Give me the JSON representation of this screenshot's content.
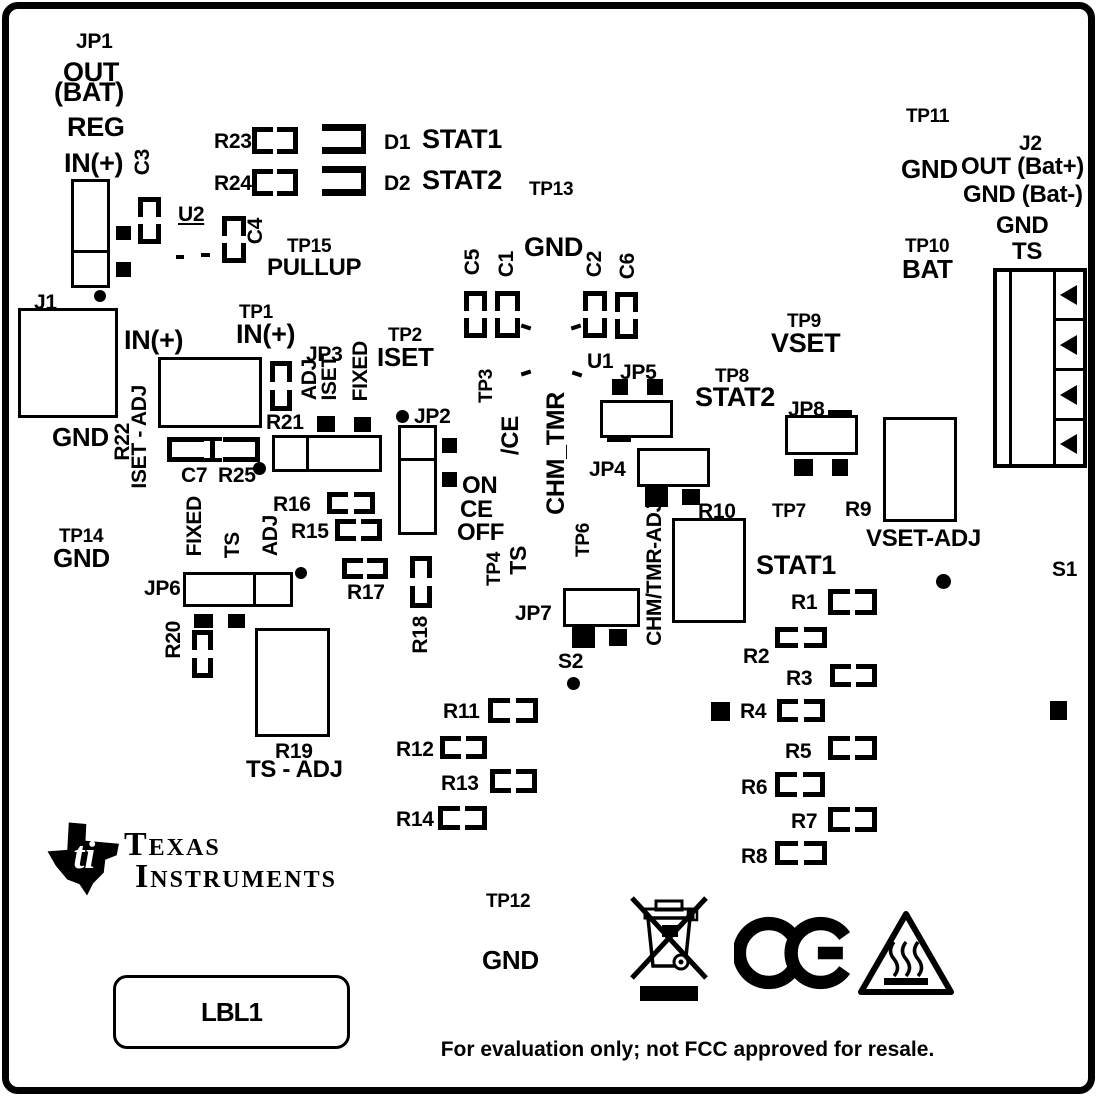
{
  "board": {
    "type": "pcb-silkscreen-diagram",
    "silkscreen_color": "#000000",
    "board_color": "#ffffff"
  },
  "labels": {
    "jp1": "JP1",
    "jp1_out": "OUT",
    "jp1_bat": "(BAT)",
    "jp1_reg": "REG",
    "jp1_in": "IN(+)",
    "c3": "C3",
    "u2": "U2",
    "c4": "C4",
    "tp15": "TP15",
    "pullup": "PULLUP",
    "r23": "R23",
    "r24": "R24",
    "d1": "D1",
    "d1_name": "STAT1",
    "d2": "D2",
    "d2_name": "STAT2",
    "tp13": "TP13",
    "gnd_top": "GND",
    "c5": "C5",
    "c1": "C1",
    "c2": "C2",
    "c6": "C6",
    "u1": "U1",
    "tp11": "TP11",
    "tp11_gnd": "GND",
    "j2": "J2",
    "j2_out": "OUT (Bat+)",
    "j2_gnd": "GND (Bat-)",
    "j2_gnd2": "GND",
    "j2_ts": "TS",
    "tp10": "TP10",
    "tp10_bat": "BAT",
    "j1": "J1",
    "j1_in": "IN(+)",
    "j1_gnd": "GND",
    "tp1": "TP1",
    "tp1_in": "IN(+)",
    "r22": "R22",
    "iset_adj": "ISET - ADJ",
    "c7": "C7",
    "r25": "R25",
    "r21": "R21",
    "jp3": "JP3",
    "jp3_adj": "ADJ",
    "jp3_iset": "ISET",
    "jp3_fixed": "FIXED",
    "tp2": "TP2",
    "tp2_iset": "ISET",
    "jp2": "JP2",
    "jp2_on": "ON",
    "jp2_ce": "CE",
    "jp2_off": "OFF",
    "tp3": "TP3",
    "ce_bar": "/CE",
    "chm_tmr": "CHM_TMR",
    "jp5": "JP5",
    "jp4": "JP4",
    "r10": "R10",
    "chm_tmr_adj": "CHM/TMR-ADJ",
    "tp6": "TP6",
    "jp7": "JP7",
    "s2": "S2",
    "tp4": "TP4",
    "tp4_ts": "TS",
    "tp9": "TP9",
    "tp9_vset": "VSET",
    "tp8": "TP8",
    "tp8_stat2": "STAT2",
    "jp8": "JP8",
    "tp7": "TP7",
    "r9": "R9",
    "vset_adj": "VSET-ADJ",
    "stat1": "STAT1",
    "r1": "R1",
    "r2": "R2",
    "r3": "R3",
    "r4": "R4",
    "r5": "R5",
    "r6": "R6",
    "r7": "R7",
    "r8": "R8",
    "s1": "S1",
    "tp14": "TP14",
    "tp14_gnd": "GND",
    "jp6": "JP6",
    "jp6_fixed": "FIXED",
    "jp6_ts": "TS",
    "jp6_adj": "ADJ",
    "r20": "R20",
    "r19": "R19",
    "ts_adj": "TS - ADJ",
    "r15": "R15",
    "r16": "R16",
    "r17": "R17",
    "r18": "R18",
    "r11": "R11",
    "r12": "R12",
    "r13": "R13",
    "r14": "R14",
    "tp12": "TP12",
    "tp12_gnd": "GND",
    "lbl1": "LBL1"
  },
  "brand": {
    "line1": "Texas",
    "line2": "Instruments",
    "monogram": "ti"
  },
  "footer": {
    "disclaimer": "For evaluation only; not FCC approved for resale."
  }
}
